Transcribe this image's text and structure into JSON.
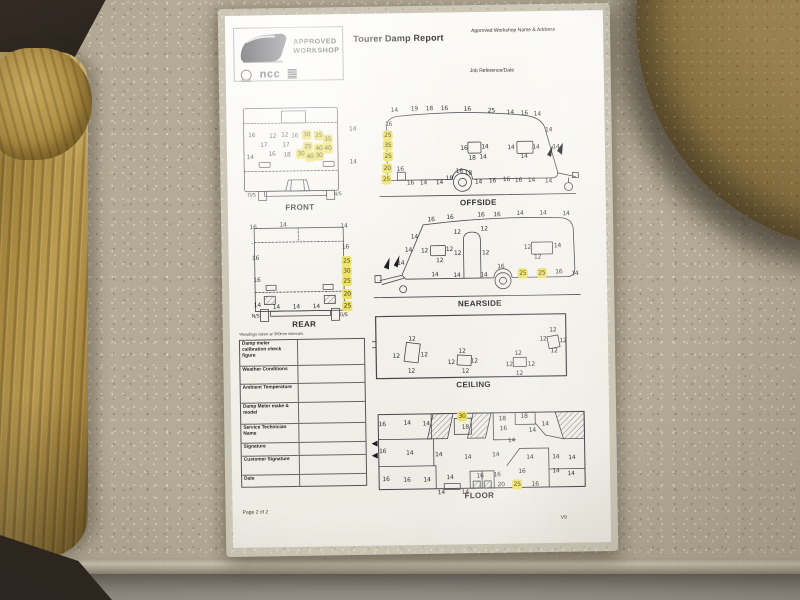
{
  "colors": {
    "highlight": "#ece05f",
    "paper": "#f4f2ec",
    "counter": "#b4ab96",
    "sofa": "#a8883f",
    "table_wood": "#a28854",
    "dark_floor": "#2b241e",
    "ink": "#2e3036"
  },
  "page": {
    "title": "Tourer Damp Report",
    "workshop_line": "Approved Workshop Name & Address",
    "job_line": "Job Reference/Date",
    "note": "*Readings taken at 300mm intervals.",
    "footer_left": "Page 2 of 2",
    "version": "V9",
    "logo": {
      "approved": "APPROVED",
      "workshop": "WORKSHOP",
      "ncc": "ncc"
    }
  },
  "table": {
    "rows": [
      "Damp meter calibration check figure",
      "Weather Conditions",
      "Ambient Temperature",
      "Damp Meter make & model",
      "Service Technician Name",
      "Signature",
      "Customer Signature",
      "Date"
    ]
  },
  "diagrams": {
    "front": {
      "caption": "FRONT",
      "readings": [
        {
          "x": 13,
          "y": 30,
          "v": "16"
        },
        {
          "x": 11,
          "y": 52,
          "v": "14"
        },
        {
          "x": 34,
          "y": 31,
          "v": "12"
        },
        {
          "x": 46,
          "y": 30,
          "v": "12"
        },
        {
          "x": 56,
          "y": 31,
          "v": "16"
        },
        {
          "x": 68,
          "y": 30,
          "v": "30",
          "hl": 1
        },
        {
          "x": 80,
          "y": 31,
          "v": "25",
          "hl": 1
        },
        {
          "x": 89,
          "y": 35,
          "v": "35",
          "hl": 1
        },
        {
          "x": 25,
          "y": 40,
          "v": "17"
        },
        {
          "x": 47,
          "y": 40,
          "v": "17"
        },
        {
          "x": 69,
          "y": 42,
          "v": "25",
          "hl": 1
        },
        {
          "x": 80,
          "y": 44,
          "v": "40",
          "hl": 1
        },
        {
          "x": 89,
          "y": 44,
          "v": "40",
          "hl": 1
        },
        {
          "x": 33,
          "y": 49,
          "v": "16"
        },
        {
          "x": 48,
          "y": 50,
          "v": "18"
        },
        {
          "x": 62,
          "y": 49,
          "v": "30",
          "hl": 1
        },
        {
          "x": 71,
          "y": 52,
          "v": "40",
          "hl": 1
        },
        {
          "x": 80,
          "y": 51,
          "v": "30",
          "hl": 1
        },
        {
          "x": 114,
          "y": 25,
          "v": "14"
        },
        {
          "x": 114,
          "y": 58,
          "v": "14"
        },
        {
          "x": 12,
          "y": 90,
          "v": "O/S",
          "t": "p"
        },
        {
          "x": 98,
          "y": 90,
          "v": "N/S",
          "t": "p"
        }
      ]
    },
    "offside": {
      "caption": "OFFSIDE",
      "readings": [
        {
          "x": 20,
          "y": 9,
          "v": "14"
        },
        {
          "x": 40,
          "y": 8,
          "v": "19"
        },
        {
          "x": 55,
          "y": 8,
          "v": "18"
        },
        {
          "x": 70,
          "y": 8,
          "v": "16"
        },
        {
          "x": 93,
          "y": 9,
          "v": "16"
        },
        {
          "x": 117,
          "y": 11,
          "v": "25"
        },
        {
          "x": 136,
          "y": 13,
          "v": "14"
        },
        {
          "x": 150,
          "y": 14,
          "v": "16"
        },
        {
          "x": 163,
          "y": 15,
          "v": "14"
        },
        {
          "x": 14,
          "y": 23,
          "v": "16"
        },
        {
          "x": 13,
          "y": 34,
          "v": "25",
          "hl": 1
        },
        {
          "x": 13,
          "y": 44,
          "v": "35",
          "hl": 1
        },
        {
          "x": 13,
          "y": 55,
          "v": "25",
          "hl": 1
        },
        {
          "x": 12,
          "y": 67,
          "v": "20",
          "hl": 1
        },
        {
          "x": 11,
          "y": 78,
          "v": "25",
          "hl": 1
        },
        {
          "x": 89,
          "y": 48,
          "v": "16"
        },
        {
          "x": 110,
          "y": 47,
          "v": "14"
        },
        {
          "x": 97,
          "y": 58,
          "v": "18"
        },
        {
          "x": 108,
          "y": 57,
          "v": "14"
        },
        {
          "x": 136,
          "y": 48,
          "v": "14"
        },
        {
          "x": 161,
          "y": 48,
          "v": "14"
        },
        {
          "x": 149,
          "y": 57,
          "v": "14"
        },
        {
          "x": 174,
          "y": 31,
          "v": "14"
        },
        {
          "x": 181,
          "y": 48,
          "v": "14"
        },
        {
          "x": 25,
          "y": 68,
          "v": "16"
        },
        {
          "x": 35,
          "y": 82,
          "v": "16"
        },
        {
          "x": 48,
          "y": 82,
          "v": "14"
        },
        {
          "x": 64,
          "y": 82,
          "v": "14"
        },
        {
          "x": 74,
          "y": 78,
          "v": "18"
        },
        {
          "x": 84,
          "y": 71,
          "v": "16"
        },
        {
          "x": 93,
          "y": 73,
          "v": "18"
        },
        {
          "x": 103,
          "y": 82,
          "v": "14"
        },
        {
          "x": 117,
          "y": 81,
          "v": "16"
        },
        {
          "x": 131,
          "y": 80,
          "v": "16"
        },
        {
          "x": 143,
          "y": 81,
          "v": "16"
        },
        {
          "x": 156,
          "y": 81,
          "v": "14"
        },
        {
          "x": 173,
          "y": 82,
          "v": "14"
        }
      ]
    },
    "rear": {
      "caption": "REAR",
      "readings": [
        {
          "x": 8,
          "y": 6,
          "v": "16"
        },
        {
          "x": 38,
          "y": 4,
          "v": "14"
        },
        {
          "x": 99,
          "y": 6,
          "v": "14"
        },
        {
          "x": 7,
          "y": 22,
          "v": "-"
        },
        {
          "x": 10,
          "y": 37,
          "v": "16"
        },
        {
          "x": 11,
          "y": 59,
          "v": "16"
        },
        {
          "x": 11,
          "y": 84,
          "v": "14"
        },
        {
          "x": 100,
          "y": 27,
          "v": "16"
        },
        {
          "x": 101,
          "y": 41,
          "v": "25",
          "hl": 1
        },
        {
          "x": 101,
          "y": 51,
          "v": "30",
          "hl": 1
        },
        {
          "x": 101,
          "y": 61,
          "v": "25",
          "hl": 1
        },
        {
          "x": 101,
          "y": 74,
          "v": "20",
          "hl": 1
        },
        {
          "x": 101,
          "y": 86,
          "v": "25",
          "hl": 1
        },
        {
          "x": 30,
          "y": 86,
          "v": "14"
        },
        {
          "x": 50,
          "y": 86,
          "v": "14"
        },
        {
          "x": 70,
          "y": 86,
          "v": "14"
        },
        {
          "x": 9,
          "y": 95,
          "v": "N/S",
          "t": "p"
        },
        {
          "x": 97,
          "y": 95,
          "v": "O/S",
          "t": "p"
        }
      ]
    },
    "nearside": {
      "caption": "NEARSIDE",
      "readings": [
        {
          "x": 60,
          "y": 11,
          "v": "16"
        },
        {
          "x": 79,
          "y": 9,
          "v": "16"
        },
        {
          "x": 110,
          "y": 7,
          "v": "16"
        },
        {
          "x": 126,
          "y": 7,
          "v": "16"
        },
        {
          "x": 149,
          "y": 6,
          "v": "14"
        },
        {
          "x": 172,
          "y": 6,
          "v": "14"
        },
        {
          "x": 195,
          "y": 7,
          "v": "14"
        },
        {
          "x": 43,
          "y": 28,
          "v": "14"
        },
        {
          "x": 37,
          "y": 41,
          "v": "14"
        },
        {
          "x": 29,
          "y": 54,
          "v": "14"
        },
        {
          "x": 53,
          "y": 42,
          "v": "12"
        },
        {
          "x": 78,
          "y": 41,
          "v": "12"
        },
        {
          "x": 68,
          "y": 52,
          "v": "12"
        },
        {
          "x": 86,
          "y": 24,
          "v": "12"
        },
        {
          "x": 113,
          "y": 21,
          "v": "12"
        },
        {
          "x": 86,
          "y": 45,
          "v": "12"
        },
        {
          "x": 114,
          "y": 45,
          "v": "12"
        },
        {
          "x": 156,
          "y": 40,
          "v": "12"
        },
        {
          "x": 186,
          "y": 39,
          "v": "14"
        },
        {
          "x": 166,
          "y": 50,
          "v": "12"
        },
        {
          "x": 63,
          "y": 66,
          "v": "14"
        },
        {
          "x": 85,
          "y": 67,
          "v": "14"
        },
        {
          "x": 112,
          "y": 67,
          "v": "14"
        },
        {
          "x": 129,
          "y": 59,
          "v": "16"
        },
        {
          "x": 151,
          "y": 66,
          "v": "25",
          "hl": 1
        },
        {
          "x": 170,
          "y": 66,
          "v": "25",
          "hl": 1
        },
        {
          "x": 187,
          "y": 65,
          "v": "16"
        },
        {
          "x": 203,
          "y": 67,
          "v": "14"
        }
      ]
    },
    "ceiling": {
      "caption": "CEILING",
      "readings": [
        {
          "x": 40,
          "y": 26,
          "v": "12"
        },
        {
          "x": 24,
          "y": 43,
          "v": "12"
        },
        {
          "x": 52,
          "y": 42,
          "v": "12"
        },
        {
          "x": 39,
          "y": 58,
          "v": "12"
        },
        {
          "x": 90,
          "y": 39,
          "v": "12"
        },
        {
          "x": 79,
          "y": 50,
          "v": "12"
        },
        {
          "x": 102,
          "y": 49,
          "v": "12"
        },
        {
          "x": 93,
          "y": 59,
          "v": "12"
        },
        {
          "x": 146,
          "y": 42,
          "v": "12"
        },
        {
          "x": 137,
          "y": 53,
          "v": "12"
        },
        {
          "x": 159,
          "y": 53,
          "v": "12"
        },
        {
          "x": 147,
          "y": 62,
          "v": "12"
        },
        {
          "x": 181,
          "y": 19,
          "v": "12"
        },
        {
          "x": 171,
          "y": 28,
          "v": "12"
        },
        {
          "x": 191,
          "y": 30,
          "v": "12"
        },
        {
          "x": 182,
          "y": 40,
          "v": "12"
        }
      ]
    },
    "floor": {
      "caption": "FLOOR",
      "readings": [
        {
          "x": 13,
          "y": 15,
          "v": "16"
        },
        {
          "x": 38,
          "y": 14,
          "v": "14"
        },
        {
          "x": 57,
          "y": 15,
          "v": "14"
        },
        {
          "x": 93,
          "y": 8,
          "v": "30",
          "hl": 1
        },
        {
          "x": 96,
          "y": 19,
          "v": "18"
        },
        {
          "x": 133,
          "y": 11,
          "v": "18"
        },
        {
          "x": 134,
          "y": 21,
          "v": "16"
        },
        {
          "x": 155,
          "y": 9,
          "v": "18"
        },
        {
          "x": 163,
          "y": 23,
          "v": "14"
        },
        {
          "x": 176,
          "y": 17,
          "v": "14"
        },
        {
          "x": 13,
          "y": 42,
          "v": "16"
        },
        {
          "x": 40,
          "y": 44,
          "v": "14"
        },
        {
          "x": 69,
          "y": 46,
          "v": "14"
        },
        {
          "x": 98,
          "y": 49,
          "v": "14"
        },
        {
          "x": 126,
          "y": 47,
          "v": "14"
        },
        {
          "x": 142,
          "y": 33,
          "v": "14"
        },
        {
          "x": 160,
          "y": 50,
          "v": "14"
        },
        {
          "x": 186,
          "y": 50,
          "v": "14"
        },
        {
          "x": 202,
          "y": 51,
          "v": "14"
        },
        {
          "x": 16,
          "y": 70,
          "v": "16"
        },
        {
          "x": 37,
          "y": 71,
          "v": "16"
        },
        {
          "x": 57,
          "y": 71,
          "v": "14"
        },
        {
          "x": 80,
          "y": 69,
          "v": "14"
        },
        {
          "x": 71,
          "y": 84,
          "v": "14"
        },
        {
          "x": 95,
          "y": 84,
          "v": "14"
        },
        {
          "x": 110,
          "y": 68,
          "v": "16"
        },
        {
          "x": 127,
          "y": 67,
          "v": "16"
        },
        {
          "x": 131,
          "y": 77,
          "v": "20"
        },
        {
          "x": 152,
          "y": 64,
          "v": "16"
        },
        {
          "x": 147,
          "y": 77,
          "v": "25",
          "hl": 1
        },
        {
          "x": 165,
          "y": 77,
          "v": "16"
        },
        {
          "x": 186,
          "y": 64,
          "v": "14"
        },
        {
          "x": 201,
          "y": 67,
          "v": "14"
        }
      ]
    }
  }
}
